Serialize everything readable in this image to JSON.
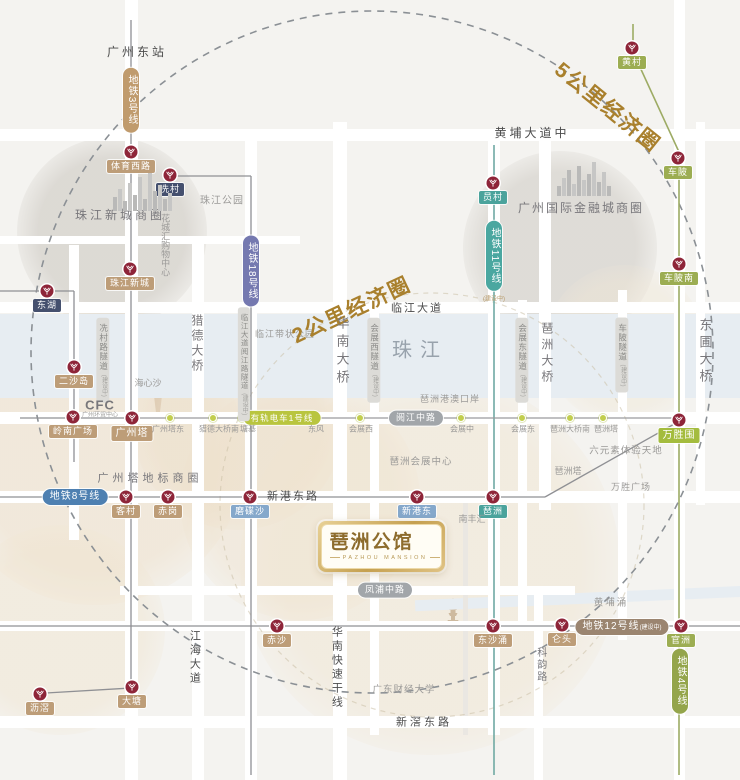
{
  "palette": {
    "gold": "#a9802d",
    "dark": "#4c4c4c",
    "mid": "#78777b",
    "gray": "#9b9a98",
    "river": "#98a2ac",
    "tan": "#bd9d78",
    "navy": "#45506e",
    "teal": "#4ba39c",
    "blue": "#85a8cb",
    "green": "#9cad52",
    "bright": "#a4bc3e",
    "marker": "#8e2539",
    "tramDot": "#c2ce4e",
    "roadWhite": "#ffffff",
    "lineGray": "#8f9094"
  },
  "logo": {
    "title": "琶洲公馆",
    "subtitle": "PAZHOU MANSION"
  },
  "map": {
    "blobs": [
      {
        "x": 112,
        "y": 232,
        "r": 95,
        "c": "rgba(205,201,194,0.60)"
      },
      {
        "x": 560,
        "y": 248,
        "r": 97,
        "c": "rgba(205,201,194,0.55)"
      },
      {
        "x": 238,
        "y": 425,
        "r": 105,
        "c": "rgba(235,220,197,0.50)"
      },
      {
        "x": 95,
        "y": 455,
        "r": 150,
        "c": "rgba(238,224,202,0.55)"
      },
      {
        "x": 300,
        "y": 500,
        "r": 120,
        "c": "rgba(238,224,202,0.45)"
      },
      {
        "x": 430,
        "y": 565,
        "r": 190,
        "c": "rgba(240,228,207,0.50)"
      },
      {
        "x": 625,
        "y": 345,
        "r": 80,
        "c": "rgba(240,231,214,0.45)"
      },
      {
        "x": 60,
        "y": 630,
        "r": 105,
        "c": "rgba(240,228,207,0.50)"
      }
    ],
    "water": [
      {
        "x": 0,
        "y": 314,
        "w": 740,
        "h": 84,
        "rot": 0
      },
      {
        "x": 415,
        "y": 593,
        "w": 330,
        "h": 11,
        "rot": -2.5
      }
    ],
    "roads": {
      "v": [
        {
          "x": 74,
          "w": 10,
          "y1": 245,
          "y2": 540
        },
        {
          "x": 131,
          "w": 13,
          "y1": 0,
          "y2": 780
        },
        {
          "x": 198,
          "w": 12,
          "y1": 240,
          "y2": 780
        },
        {
          "x": 251,
          "w": 12,
          "y1": 130,
          "y2": 780
        },
        {
          "x": 340,
          "w": 14,
          "y1": 122,
          "y2": 780
        },
        {
          "x": 374,
          "w": 9,
          "y1": 300,
          "y2": 735
        },
        {
          "x": 465,
          "w": 5,
          "y1": 497,
          "y2": 735,
          "c": "#eae7e2"
        },
        {
          "x": 494,
          "w": 12,
          "y1": 130,
          "y2": 735
        },
        {
          "x": 522,
          "w": 9,
          "y1": 300,
          "y2": 630
        },
        {
          "x": 545,
          "w": 12,
          "y1": 128,
          "y2": 510
        },
        {
          "x": 538,
          "w": 9,
          "y1": 588,
          "y2": 780
        },
        {
          "x": 622,
          "w": 9,
          "y1": 290,
          "y2": 640
        },
        {
          "x": 679,
          "w": 11,
          "y1": 0,
          "y2": 780
        },
        {
          "x": 700,
          "w": 9,
          "y1": 122,
          "y2": 505
        }
      ],
      "h": [
        {
          "y": 135,
          "h": 12,
          "x1": 0,
          "x2": 740
        },
        {
          "y": 240,
          "h": 8,
          "x1": 0,
          "x2": 300
        },
        {
          "y": 307,
          "h": 11,
          "x1": 0,
          "x2": 740
        },
        {
          "y": 418,
          "h": 12,
          "x1": 0,
          "x2": 740
        },
        {
          "y": 497,
          "h": 12,
          "x1": 0,
          "x2": 740
        },
        {
          "y": 590,
          "h": 9,
          "x1": 120,
          "x2": 575
        },
        {
          "y": 626,
          "h": 10,
          "x1": 0,
          "x2": 740
        },
        {
          "y": 722,
          "h": 12,
          "x1": 0,
          "x2": 740
        }
      ]
    },
    "rings": [
      {
        "cx": 372,
        "cy": 352,
        "r": 341,
        "dash": "7 6",
        "c": "#8b9095",
        "w": 1.6,
        "o": 1
      },
      {
        "cx": 432,
        "cy": 505,
        "r": 212,
        "dash": "5 5",
        "c": "#cbbfa6",
        "w": 1.2,
        "o": 0.55
      }
    ],
    "lines": [
      {
        "x1": 131,
        "y1": 20,
        "x2": 131,
        "y2": 700
      },
      {
        "x1": 131,
        "y1": 688,
        "x2": 46,
        "y2": 693
      },
      {
        "x1": 170,
        "y1": 176,
        "x2": 251,
        "y2": 176
      },
      {
        "x1": 251,
        "y1": 176,
        "x2": 251,
        "y2": 775
      },
      {
        "x1": 494,
        "y1": 145,
        "x2": 494,
        "y2": 775,
        "c": "#6fa9a3",
        "w": 1.6
      },
      {
        "x1": 633,
        "y1": 24,
        "x2": 633,
        "y2": 52,
        "c": "#9dab64",
        "w": 1.6
      },
      {
        "x1": 633,
        "y1": 52,
        "x2": 679,
        "y2": 152,
        "c": "#9dab64",
        "w": 1.6
      },
      {
        "x1": 679,
        "y1": 152,
        "x2": 679,
        "y2": 775,
        "c": "#9dab64",
        "w": 1.6
      },
      {
        "x1": 0,
        "y1": 497,
        "x2": 545,
        "y2": 497
      },
      {
        "x1": 545,
        "y1": 497,
        "x2": 676,
        "y2": 423
      },
      {
        "x1": 0,
        "y1": 626,
        "x2": 740,
        "y2": 626
      },
      {
        "x1": 0,
        "y1": 291,
        "x2": 74,
        "y2": 291
      },
      {
        "x1": 74,
        "y1": 291,
        "x2": 74,
        "y2": 462
      },
      {
        "x1": 20,
        "y1": 418,
        "x2": 131,
        "y2": 418
      },
      {
        "x1": 131,
        "y1": 418,
        "x2": 679,
        "y2": 418,
        "c": "#9a9b9d"
      }
    ],
    "tram_dots": [
      [
        170,
        418
      ],
      [
        213,
        418
      ],
      [
        242,
        418
      ],
      [
        315,
        418
      ],
      [
        360,
        418
      ],
      [
        461,
        418
      ],
      [
        522,
        418
      ],
      [
        570,
        418
      ],
      [
        603,
        418
      ]
    ],
    "stations": [
      {
        "x": 131,
        "y": 152,
        "t": "体育西路",
        "bg": "tan"
      },
      {
        "x": 170,
        "y": 175,
        "t": "冼村",
        "bg": "navy"
      },
      {
        "x": 130,
        "y": 269,
        "t": "珠江新城",
        "bg": "tan"
      },
      {
        "x": 47,
        "y": 291,
        "t": "东湖",
        "bg": "navy"
      },
      {
        "x": 74,
        "y": 367,
        "t": "二沙岛",
        "bg": "tan"
      },
      {
        "x": 73,
        "y": 417,
        "t": "岭南广场",
        "bg": "tan"
      },
      {
        "x": 132,
        "y": 418,
        "t": "广州塔",
        "bg": "tan",
        "big": 1
      },
      {
        "x": 493,
        "y": 183,
        "t": "员村",
        "bg": "teal"
      },
      {
        "x": 632,
        "y": 48,
        "t": "黄村",
        "bg": "green"
      },
      {
        "x": 678,
        "y": 158,
        "t": "车陂",
        "bg": "green"
      },
      {
        "x": 679,
        "y": 264,
        "t": "车陂南",
        "bg": "green"
      },
      {
        "x": 679,
        "y": 420,
        "t": "万胜围",
        "bg": "bright",
        "big": 1
      },
      {
        "x": 126,
        "y": 497,
        "t": "客村",
        "bg": "tan"
      },
      {
        "x": 168,
        "y": 497,
        "t": "赤岗",
        "bg": "tan"
      },
      {
        "x": 250,
        "y": 497,
        "t": "磨碟沙",
        "bg": "blue"
      },
      {
        "x": 417,
        "y": 497,
        "t": "新港东",
        "bg": "blue"
      },
      {
        "x": 493,
        "y": 497,
        "t": "琶洲",
        "bg": "teal"
      },
      {
        "x": 277,
        "y": 626,
        "t": "赤沙",
        "bg": "tan"
      },
      {
        "x": 493,
        "y": 626,
        "t": "东沙涌",
        "bg": "tan"
      },
      {
        "x": 562,
        "y": 625,
        "t": "仑头",
        "bg": "tan"
      },
      {
        "x": 681,
        "y": 626,
        "t": "官洲",
        "bg": "green"
      },
      {
        "x": 132,
        "y": 687,
        "t": "大塘",
        "bg": "tan"
      },
      {
        "x": 40,
        "y": 694,
        "t": "沥滘",
        "bg": "tan"
      }
    ],
    "pills": [
      {
        "t": "地铁3号线",
        "x": 131,
        "y": 100,
        "bg": "#c09b6d",
        "v": 1
      },
      {
        "t": "地铁18号线",
        "x": 251,
        "y": 271,
        "bg": "#7579b0",
        "v": 1
      },
      {
        "t": "地铁11号线",
        "x": 494,
        "y": 256,
        "bg": "#4aa7a0",
        "v": 1,
        "n": "(建设中)"
      },
      {
        "t": "地铁8号线",
        "x": 75,
        "y": 497,
        "bg": "#4e80b1"
      },
      {
        "t": "有轨电车1号线",
        "x": 282,
        "y": 418,
        "bg": "#b9c53f",
        "s": 8.5
      },
      {
        "t": "阅江中路",
        "x": 416,
        "y": 418,
        "bg": "#a2a6aa",
        "s": 9
      },
      {
        "t": "凤浦中路",
        "x": 385,
        "y": 590,
        "bg": "#a2a6aa",
        "s": 9
      },
      {
        "t": "地铁12号线",
        "x": 622,
        "y": 627,
        "bg": "#9b8570",
        "n2": "(建设中)"
      },
      {
        "t": "地铁4号线",
        "x": 680,
        "y": 681,
        "bg": "#94a54b",
        "v": 1
      }
    ],
    "tunnel_note": "(建设中)",
    "tunnels": [
      {
        "t": "冼村路隧道",
        "x": 103,
        "y": 360
      },
      {
        "t": "临江大道阅江路隧道",
        "x": 244,
        "y": 364,
        "s": 7.5
      },
      {
        "t": "会展西隧道",
        "x": 374,
        "y": 360
      },
      {
        "t": "会展东隧道",
        "x": 522,
        "y": 360
      },
      {
        "t": "车陂隧道",
        "x": 622,
        "y": 355
      }
    ],
    "texts": [
      {
        "t": "广州东站",
        "x": 137,
        "y": 53,
        "s": 12,
        "c": "dark",
        "ls": 3
      },
      {
        "t": "黄埔大道中",
        "x": 532,
        "y": 134,
        "s": 12,
        "c": "dark",
        "ls": 3
      },
      {
        "t": "珠江公园",
        "x": 222,
        "y": 201,
        "s": 10,
        "c": "gray",
        "ls": 1
      },
      {
        "t": "珠江新城商圈",
        "x": 120,
        "y": 216,
        "s": 12,
        "c": "mid",
        "ls": 3
      },
      {
        "t": "花城汇购物中心",
        "x": 165,
        "y": 245,
        "s": 9,
        "c": "gray",
        "v": 1
      },
      {
        "t": "广州国际金融城商圈",
        "x": 581,
        "y": 209,
        "s": 12,
        "c": "mid",
        "ls": 2
      },
      {
        "t": "猎德大桥",
        "x": 196,
        "y": 344,
        "s": 12,
        "c": "mid",
        "v": 1,
        "ls": 3
      },
      {
        "t": "临江大道",
        "x": 417,
        "y": 309,
        "s": 11,
        "c": "dark",
        "ls": 2
      },
      {
        "t": "临江带状公园",
        "x": 285,
        "y": 334,
        "s": 9,
        "c": "gray",
        "ls": 1
      },
      {
        "t": "2公里经济圈",
        "x": 352,
        "y": 311,
        "s": 21,
        "c": "gold",
        "r": -25,
        "b": 1,
        "ls": 2
      },
      {
        "t": "5公里经济圈",
        "x": 607,
        "y": 108,
        "s": 21,
        "c": "gold",
        "r": 39,
        "b": 1,
        "ls": 2
      },
      {
        "t": "华南大桥",
        "x": 341,
        "y": 352,
        "s": 13,
        "c": "mid",
        "v": 1,
        "ls": 5
      },
      {
        "t": "珠江",
        "x": 420,
        "y": 351,
        "s": 20,
        "c": "river",
        "ls": 8
      },
      {
        "t": "海心沙",
        "x": 148,
        "y": 383,
        "s": 9,
        "c": "gray"
      },
      {
        "t": "琶洲港澳口岸",
        "x": 450,
        "y": 399,
        "s": 9,
        "c": "gray",
        "ls": 1
      },
      {
        "t": "琶洲大桥",
        "x": 546,
        "y": 354,
        "s": 12,
        "c": "mid",
        "v": 1,
        "ls": 4
      },
      {
        "t": "东圃大桥",
        "x": 704,
        "y": 352,
        "s": 13,
        "c": "mid",
        "v": 1,
        "ls": 4
      },
      {
        "t": "CFC",
        "x": 100,
        "y": 406,
        "s": 13,
        "c": "mid",
        "b": 1,
        "ls": 1
      },
      {
        "t": "广州环贸中心",
        "x": 100,
        "y": 416,
        "s": 6,
        "c": "gray"
      },
      {
        "t": "广州塔东",
        "x": 168,
        "y": 429,
        "s": 8,
        "c": "gray"
      },
      {
        "t": "猎德大桥南",
        "x": 219,
        "y": 429,
        "s": 8,
        "c": "gray"
      },
      {
        "t": "塘基",
        "x": 248,
        "y": 429,
        "s": 8,
        "c": "gray"
      },
      {
        "t": "东风",
        "x": 316,
        "y": 429,
        "s": 8,
        "c": "gray"
      },
      {
        "t": "会展西",
        "x": 361,
        "y": 429,
        "s": 8,
        "c": "gray"
      },
      {
        "t": "会展中",
        "x": 462,
        "y": 429,
        "s": 8,
        "c": "gray"
      },
      {
        "t": "会展东",
        "x": 523,
        "y": 429,
        "s": 8,
        "c": "gray"
      },
      {
        "t": "琶洲大桥南",
        "x": 570,
        "y": 429,
        "s": 8,
        "c": "gray"
      },
      {
        "t": "琶洲塔",
        "x": 606,
        "y": 429,
        "s": 8,
        "c": "gray"
      },
      {
        "t": "六元素体验天地",
        "x": 626,
        "y": 452,
        "s": 9.5,
        "c": "gray",
        "ls": 1
      },
      {
        "t": "琶洲会展中心",
        "x": 421,
        "y": 463,
        "s": 9.5,
        "c": "gray",
        "ls": 1
      },
      {
        "t": "琶洲塔",
        "x": 568,
        "y": 471,
        "s": 9,
        "c": "gray"
      },
      {
        "t": "广州塔地标商圈",
        "x": 150,
        "y": 479,
        "s": 11,
        "c": "mid",
        "ls": 4
      },
      {
        "t": "万胜广场",
        "x": 631,
        "y": 487,
        "s": 9,
        "c": "gray",
        "ls": 1
      },
      {
        "t": "新港东路",
        "x": 293,
        "y": 497,
        "s": 11,
        "c": "dark",
        "ls": 2
      },
      {
        "t": "南丰汇",
        "x": 472,
        "y": 519,
        "s": 9,
        "c": "gray"
      },
      {
        "t": "黄埔涌",
        "x": 611,
        "y": 604,
        "s": 9.5,
        "c": "gray",
        "ls": 2
      },
      {
        "t": "科韵路",
        "x": 540,
        "y": 665,
        "s": 10,
        "c": "mid",
        "v": 1,
        "ls": 2
      },
      {
        "t": "华南快速干线",
        "x": 336,
        "y": 668,
        "s": 11,
        "c": "dark",
        "v": 1,
        "ls": 3
      },
      {
        "t": "江海大道",
        "x": 194,
        "y": 658,
        "s": 11,
        "c": "dark",
        "v": 1,
        "ls": 3
      },
      {
        "t": "广东财经大学",
        "x": 404,
        "y": 691,
        "s": 9.5,
        "c": "gray",
        "ls": 1
      },
      {
        "t": "新滘东路",
        "x": 424,
        "y": 723,
        "s": 11,
        "c": "dark",
        "ls": 3
      }
    ],
    "skylines": [
      {
        "x": 113,
        "bottom": 211,
        "bars": [
          14,
          22,
          10,
          28,
          16,
          34,
          12,
          38,
          20,
          26,
          12,
          18
        ]
      },
      {
        "x": 557,
        "bottom": 196,
        "bars": [
          10,
          18,
          26,
          12,
          30,
          16,
          22,
          34,
          14,
          24,
          10
        ]
      }
    ]
  }
}
